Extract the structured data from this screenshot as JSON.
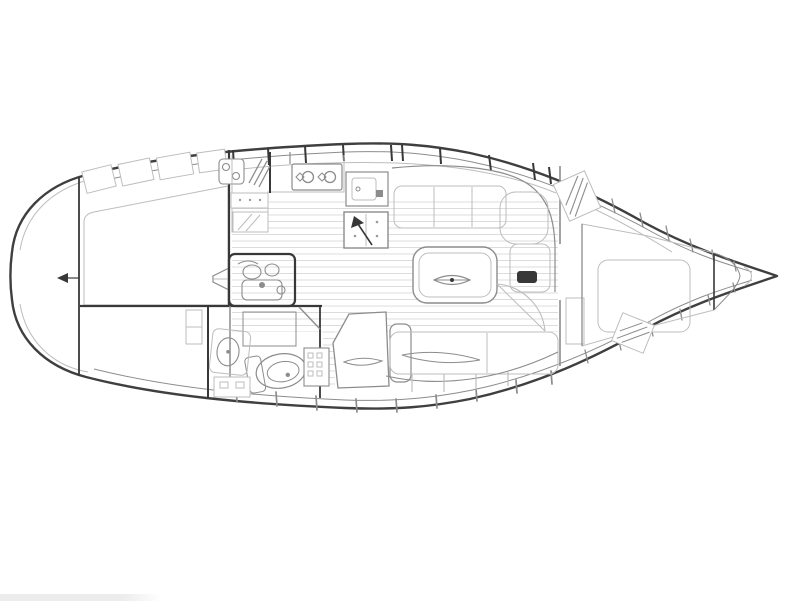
{
  "drawing": {
    "kind": "sailing-yacht-interior-layout-plan",
    "orientation": "bow-right",
    "regions": [
      {
        "id": "hull",
        "name": "hull-outline"
      },
      {
        "id": "stern-lazarette",
        "name": "stern-lazarette"
      },
      {
        "id": "aft-cabin",
        "name": "aft-double-cabin"
      },
      {
        "id": "galley",
        "name": "galley"
      },
      {
        "id": "engine",
        "name": "engine-compartment"
      },
      {
        "id": "companionway",
        "name": "companionway-steps"
      },
      {
        "id": "head",
        "name": "head-compartment"
      },
      {
        "id": "nav",
        "name": "nav-station"
      },
      {
        "id": "salon",
        "name": "salon"
      },
      {
        "id": "vberth",
        "name": "forward-v-berth-cabin"
      },
      {
        "id": "bow",
        "name": "anchor-locker-bow"
      }
    ]
  },
  "colors": {
    "background": "#ffffff",
    "hull_outline": "#3f3f3f",
    "bulkhead": "#383838",
    "furniture_medium": "#8c8c8c",
    "furniture_light": "#bdbdbd",
    "upholstery_dot": "#9a9a9a",
    "floor_plank": "#dcdcdc",
    "crosshatch": "#707070",
    "artifact_bar": "#ececec"
  }
}
